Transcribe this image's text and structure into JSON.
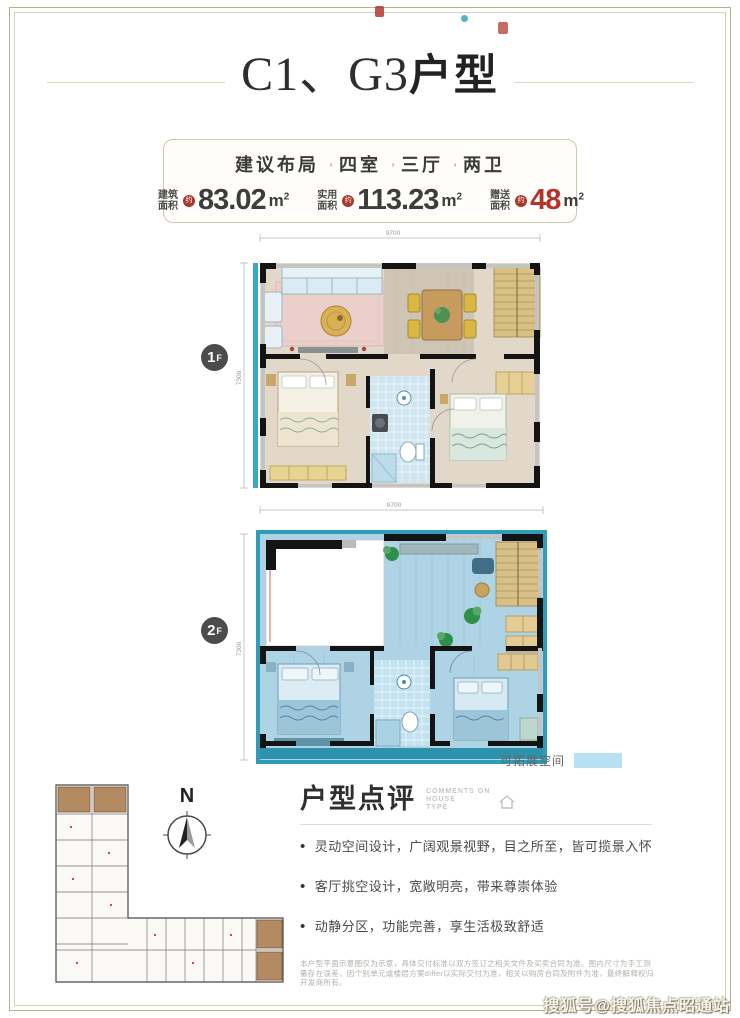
{
  "page_title": {
    "prefix": "C1、G3",
    "suffix": "户型"
  },
  "info_box": {
    "layout_label": "建议布局",
    "layout_segments": [
      "四室",
      "三厅",
      "两卫"
    ],
    "stats": [
      {
        "label_line1": "建筑",
        "label_line2": "面积",
        "approx": "约",
        "value": "83.02",
        "unit": "m",
        "unit_sup": "2"
      },
      {
        "label_line1": "实用",
        "label_line2": "面积",
        "approx": "约",
        "value": "113.23",
        "unit": "m",
        "unit_sup": "2"
      },
      {
        "label_line1": "赠送",
        "label_line2": "面积",
        "approx": "约",
        "value": "48",
        "unit": "m",
        "unit_sup": "2",
        "value_color": "#b5342a"
      }
    ]
  },
  "floors": {
    "f1": {
      "num": "1",
      "suffix": "F",
      "dim_top": "9700",
      "dim_left": "7306"
    },
    "f2": {
      "num": "2",
      "suffix": "F",
      "dim_top": "9700",
      "dim_left": "7306"
    }
  },
  "legend": {
    "label": "可拓展空间",
    "swatch_color": "#b7e0f2"
  },
  "compass": {
    "label": "N"
  },
  "review": {
    "title": "户型点评",
    "subtitle_line1": "COMMENTS ON",
    "subtitle_line2": "HOUSE",
    "subtitle_line3": "TYPE",
    "bullets": [
      "灵动空间设计，广阔观景视野，目之所至，皆可揽景入怀",
      "客厅挑空设计，宽敞明亮，带来尊崇体验",
      "动静分区，功能完善，享生活极致舒适"
    ],
    "disclaimer": "本户型平面示意图仅为示意，具体交付标准以双方签订之相关文件及买卖合同为准。图内尺寸为手工测量存在误差，因个别单元或楼层方案differ以实际交付为准，相关以购房合同及附件为准，最终解释权归开发商所有。"
  },
  "watermark": "搜狐号@搜狐焦点昭通站",
  "colors": {
    "accent_red": "#b5342a",
    "expandable_blue": "#aed3e4",
    "boundary_teal": "#2f9cb8",
    "frame_gold": "#b7ae8a"
  }
}
